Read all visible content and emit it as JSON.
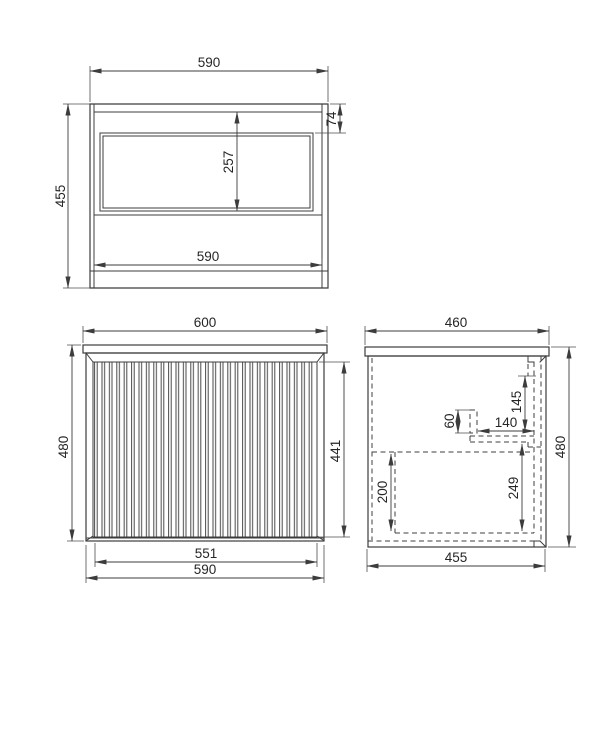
{
  "drawing": {
    "title": "Wall-hung vanity cabinet dimension drawing",
    "background": "#ffffff",
    "line_color": "#3c3c3c",
    "views": {
      "top": {
        "name": "top-view",
        "dims": {
          "width_top": "590",
          "depth_left": "455",
          "back_rail_depth": "74",
          "opening_depth": "257",
          "width_bottom": "590"
        }
      },
      "front": {
        "name": "front-view",
        "dims": {
          "overall_width": "600",
          "overall_height": "480",
          "panel_height": "441",
          "panel_width": "551",
          "cabinet_width": "590"
        }
      },
      "side": {
        "name": "side-view",
        "dims": {
          "overall_depth": "460",
          "overall_height": "480",
          "hanger_offset": "145",
          "cutout_height": "60",
          "cutout_depth": "140",
          "drawer_inner_height": "200",
          "cavity_height": "249",
          "cabinet_depth": "455"
        }
      }
    }
  }
}
